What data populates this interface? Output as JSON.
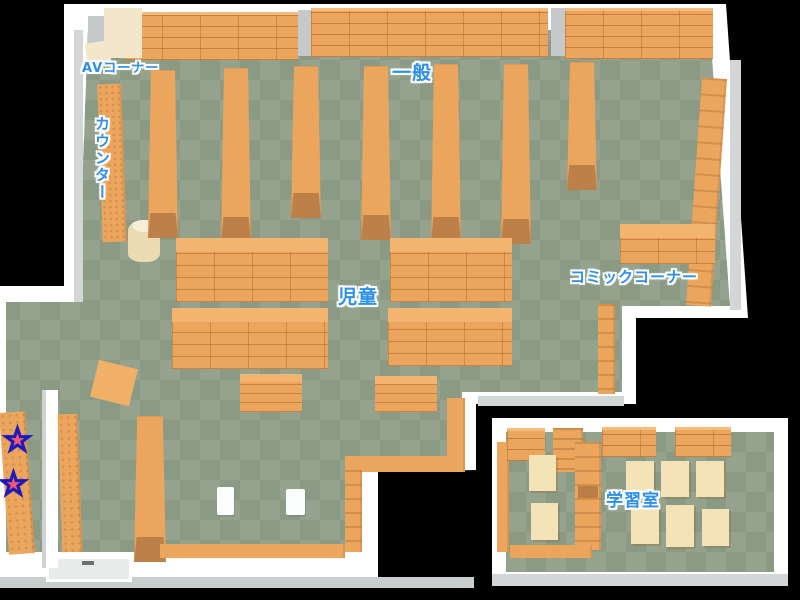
{
  "map": {
    "name": "library-floor-map",
    "labels": {
      "av_corner": "AVコーナー",
      "general": "一般",
      "counter": "カウンター",
      "children": "児童",
      "comic_corner": "コミックコーナー",
      "study_room": "学習室"
    },
    "markers": {
      "star_glyph": "★",
      "star_count": 2
    },
    "colors": {
      "background": "#000000",
      "floor_dark": "#8b9a85",
      "floor_light": "#95a38e",
      "wall": "#ffffff",
      "wall_shade": "#d2d6d7",
      "shelf": "#eca55c",
      "shelf_top": "#f3b470",
      "shelf_cap": "#bd8049",
      "av_unit": "#f3e7cb",
      "table": "#f3e3b6",
      "label_text": "#2b8fec",
      "star_fill": "#f8566e",
      "star_stroke": "#1a1abe"
    }
  }
}
